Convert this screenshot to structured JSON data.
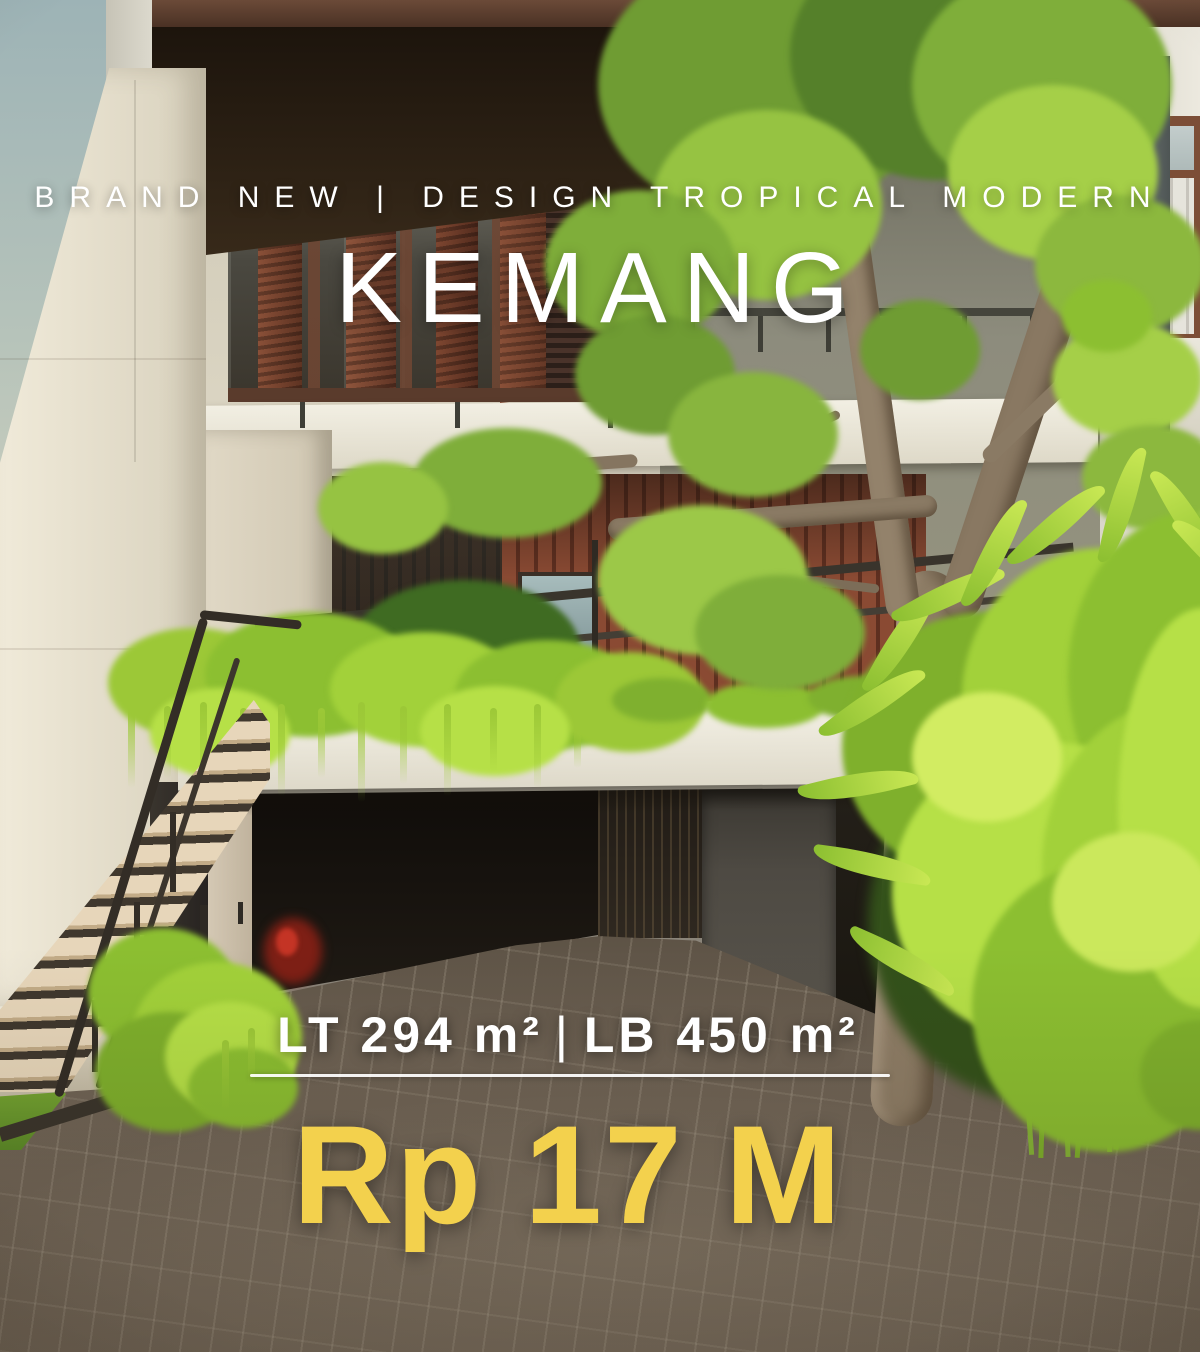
{
  "listing": {
    "tagline": "BRAND NEW | DESIGN TROPICAL MODERN",
    "title": "KEMANG",
    "land_area": "LT 294 m²",
    "separator": "|",
    "building_area": "LB 450 m²",
    "price": "Rp 17 M"
  },
  "colors": {
    "price_yellow": "#F3D14D",
    "text_white": "#FFFFFF"
  }
}
